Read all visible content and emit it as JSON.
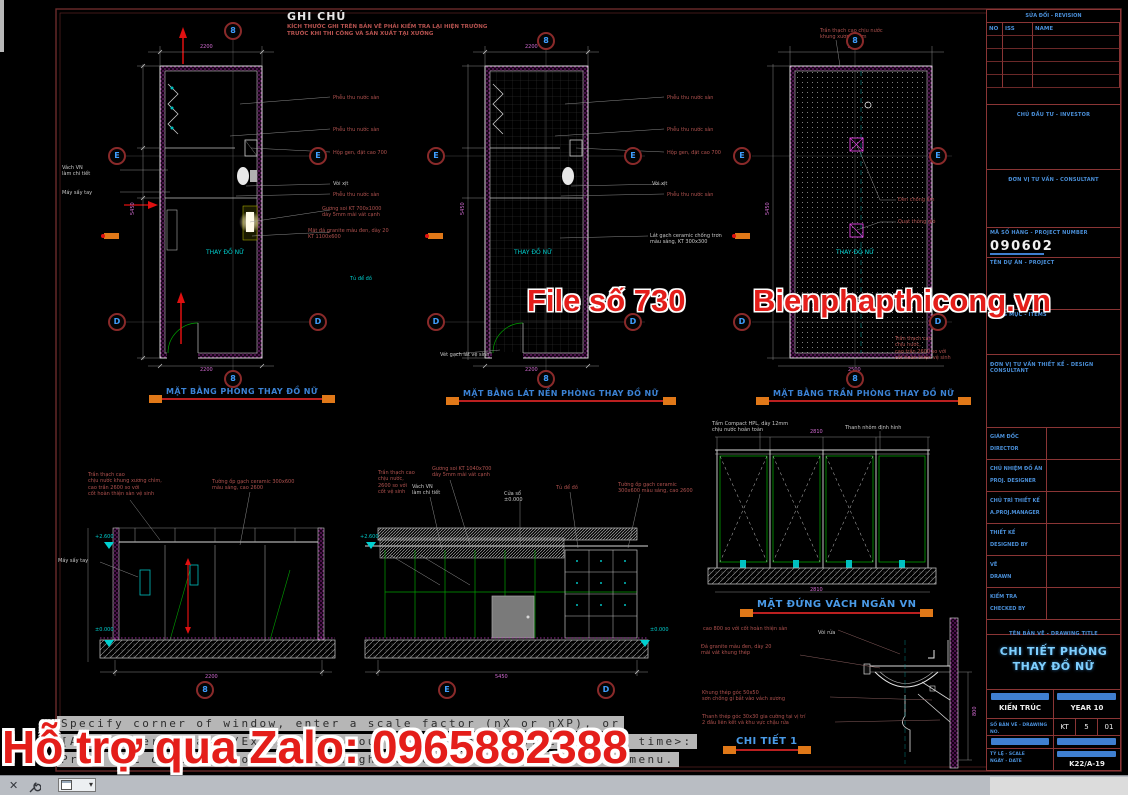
{
  "note": {
    "title": "GHI CHÚ",
    "body": "KÍCH THƯỚC GHI TRÊN BẢN VẼ PHẢI KIỂM TRA LẠI HIỆN TRƯỜNG TRƯỚC KHI THI CÔNG VÀ SẢN XUẤT TẠI XƯỞNG"
  },
  "watermarks": {
    "file_no": "File số 730",
    "site": "Bienphapthicong.vn",
    "zalo": "Hỗ trợ qua Zalo: 0965882388"
  },
  "drawing_titles": {
    "plan1": "MẶT BẰNG PHÒNG THAY ĐỒ NỮ",
    "plan2": "MẶT BẰNG LÁT NỀN PHÒNG THAY ĐỒ NỮ",
    "plan3": "MẶT BẰNG TRẦN PHÒNG THAY ĐỒ NỮ",
    "elevation": "MẶT ĐỨNG VÁCH NGĂN VN",
    "detail": "CHI TIẾT 1"
  },
  "titleblock": {
    "revision_title": "SỬA ĐỔI - REVISION",
    "revision_headers": [
      "NO",
      "ISS",
      "NAME"
    ],
    "investor_label": "CHỦ ĐẦU TƯ - INVESTOR",
    "consultant_label": "ĐƠN VỊ TƯ VẤN - CONSULTANT",
    "project_number_label": "MÃ SỐ HÀNG - PROJECT NUMBER",
    "project_number": "090602",
    "project_label": "TÊN DỰ ÁN - PROJECT",
    "items_label": "HẠNG MỤC - ITEMS",
    "design_unit_label": "ĐƠN VỊ TƯ VẤN THIẾT KẾ - DESIGN CONSULTANT",
    "staff_rows": [
      {
        "vn": "GIÁM ĐỐC",
        "en": "DIRECTOR"
      },
      {
        "vn": "CHỦ NHIỆM ĐỒ ÁN",
        "en": "PROJ. DESIGNER"
      },
      {
        "vn": "CHỦ TRÌ THIẾT KẾ",
        "en": "A.PROJ.MANAGER"
      },
      {
        "vn": "THIẾT KẾ",
        "en": "DESIGNED BY"
      },
      {
        "vn": "VẼ",
        "en": "DRAWN"
      },
      {
        "vn": "KIỂM TRA",
        "en": "CHECKED BY"
      }
    ],
    "drawing_title_label": "TÊN BẢN VẼ - DRAWING TITLE",
    "drawing_title_line1": "CHI TIẾT PHÒNG",
    "drawing_title_line2": "THAY ĐỒ NỮ",
    "discipline": "KIẾN TRÚC",
    "year_label": "YEAR 10",
    "dwg_no_label": "SỐ BẢN VẼ - DRAWING NO.",
    "dwg_series": "KT",
    "sheet_no": "5",
    "sheet_total": "01",
    "scale_label": "TỶ LỆ - SCALE",
    "date_label": "NGÀY - DATE",
    "code": "K22/A-19"
  },
  "command_line": {
    "line1": "Specify corner of window, enter a scale factor (nX or nXP), or",
    "line2": "[All/Center/Dynamic/Extents/Previous/Scale/Window/Object] <real time>:",
    "line3": "Press ESC or ENTER to exit, or right-click to display shortcut menu."
  },
  "bubbles": [
    {
      "l": "8",
      "x": 233,
      "y": 31
    },
    {
      "l": "E",
      "x": 117,
      "y": 156
    },
    {
      "l": "E",
      "x": 318,
      "y": 156
    },
    {
      "l": "D",
      "x": 117,
      "y": 322
    },
    {
      "l": "D",
      "x": 318,
      "y": 322
    },
    {
      "l": "8",
      "x": 233,
      "y": 379
    },
    {
      "l": "8",
      "x": 546,
      "y": 41
    },
    {
      "l": "E",
      "x": 436,
      "y": 156
    },
    {
      "l": "E",
      "x": 633,
      "y": 156
    },
    {
      "l": "D",
      "x": 436,
      "y": 322
    },
    {
      "l": "D",
      "x": 633,
      "y": 322
    },
    {
      "l": "8",
      "x": 546,
      "y": 379
    },
    {
      "l": "8",
      "x": 855,
      "y": 41
    },
    {
      "l": "E",
      "x": 742,
      "y": 156
    },
    {
      "l": "E",
      "x": 938,
      "y": 156
    },
    {
      "l": "D",
      "x": 742,
      "y": 322
    },
    {
      "l": "D",
      "x": 938,
      "y": 322
    },
    {
      "l": "8",
      "x": 855,
      "y": 379
    },
    {
      "l": "8",
      "x": 205,
      "y": 690
    },
    {
      "l": "E",
      "x": 447,
      "y": 690
    },
    {
      "l": "D",
      "x": 606,
      "y": 690
    }
  ],
  "labels": [
    {
      "t": "Phễu thu nước sàn",
      "x": 333,
      "y": 95
    },
    {
      "t": "Phễu thu nước sàn",
      "x": 333,
      "y": 127
    },
    {
      "t": "Hộp gen, đặt cao 700",
      "x": 333,
      "y": 150
    },
    {
      "t": "Vòi xịt",
      "x": 333,
      "y": 181,
      "c": "#c8c8c8"
    },
    {
      "t": "Phễu thu nước sàn",
      "x": 333,
      "y": 192
    },
    {
      "t": "Gương soi KT 700x1000\ndày 5mm mài vát cạnh",
      "x": 322,
      "y": 206
    },
    {
      "t": "Mặt đá granite màu đen, dày 20\nKT 1100x600",
      "x": 308,
      "y": 228
    },
    {
      "t": "Vách VN\nlàm chi tiết",
      "x": 62,
      "y": 165,
      "c": "#c8c8c8"
    },
    {
      "t": "Máy sấy tay",
      "x": 62,
      "y": 190,
      "c": "#c8c8c8"
    },
    {
      "t": "THAY ĐỒ NỮ",
      "x": 206,
      "y": 249,
      "c": "#00cccc",
      "s": 6
    },
    {
      "t": "Tủ để đồ",
      "x": 350,
      "y": 276,
      "c": "#00cccc"
    },
    {
      "t": "Phễu thu nước sàn",
      "x": 667,
      "y": 95
    },
    {
      "t": "Phễu thu nước sàn",
      "x": 667,
      "y": 127
    },
    {
      "t": "Hộp gen, đặt cao 700",
      "x": 667,
      "y": 150
    },
    {
      "t": "Vòi xịt",
      "x": 652,
      "y": 181,
      "c": "#c8c8c8"
    },
    {
      "t": "Phễu thu nước sàn",
      "x": 667,
      "y": 192
    },
    {
      "t": "Lát gạch ceramic chống trơn\nmàu sáng, KT 300x300",
      "x": 650,
      "y": 233,
      "c": "#c8c8c8"
    },
    {
      "t": "THAY ĐỒ NỮ",
      "x": 514,
      "y": 249,
      "c": "#00cccc",
      "s": 6
    },
    {
      "t": "Vét gạch lát vệ sinh",
      "x": 440,
      "y": 352,
      "c": "#c8c8c8"
    },
    {
      "t": "Trần thạch cao chịu nước\nkhung xương chìm",
      "x": 820,
      "y": 28
    },
    {
      "t": "Đèn chống ẩm",
      "x": 898,
      "y": 197
    },
    {
      "t": "Quạt thông gió",
      "x": 898,
      "y": 219
    },
    {
      "t": "THAY ĐỒ NỮ",
      "x": 836,
      "y": 249,
      "c": "#00cccc",
      "s": 6
    },
    {
      "t": "Trần thạch cao\nchịu nước,\ncao trần 2600 so với\ncốt hoàn thiện vệ sinh",
      "x": 895,
      "y": 336
    },
    {
      "t": "Trần thạch cao\nchịu nước khung xương chìm,\ncao trần 2600 so với\ncốt hoàn thiện sàn vệ sinh",
      "x": 88,
      "y": 472
    },
    {
      "t": "Tường ốp gạch ceramic 300x600\nmàu sáng, cao 2600",
      "x": 212,
      "y": 479
    },
    {
      "t": "Máy sấy tay",
      "x": 58,
      "y": 558,
      "c": "#c8c8c8"
    },
    {
      "t": "Trần thạch cao\nchịu nước,\n2600 so với\ncốt vệ sinh",
      "x": 378,
      "y": 470
    },
    {
      "t": "Gương soi KT 1040x700\ndày 5mm mài vát cạnh",
      "x": 432,
      "y": 466
    },
    {
      "t": "Vách VN\nlàm chi tiết",
      "x": 412,
      "y": 484,
      "c": "#c8c8c8"
    },
    {
      "t": "Cửa sổ\n±0.000",
      "x": 504,
      "y": 491,
      "c": "#c8c8c8"
    },
    {
      "t": "Tủ để đồ",
      "x": 556,
      "y": 485
    },
    {
      "t": "Tường ốp gạch ceramic\n300x600 màu sáng, cao 2600",
      "x": 618,
      "y": 482
    },
    {
      "t": "Tấm Compact HPL, dày 12mm\nchịu nước hoàn toàn",
      "x": 712,
      "y": 421,
      "c": "#c8c8c8"
    },
    {
      "t": "Thanh nhôm định hình",
      "x": 845,
      "y": 425,
      "c": "#c8c8c8"
    },
    {
      "t": "cao 800 so với cốt hoàn thiện sàn",
      "x": 703,
      "y": 626
    },
    {
      "t": "Vòi rửa",
      "x": 818,
      "y": 630,
      "c": "#c8c8c8"
    },
    {
      "t": "Đá granite màu đen, dày 20\nmài vát khung thép",
      "x": 701,
      "y": 644
    },
    {
      "t": "Khung thép góc 50x50\nsơn chống gỉ bắt vào vách xương",
      "x": 702,
      "y": 690
    },
    {
      "t": "Thanh thép góc 30x30 gia cường tại vị trí\n2 đầu liên kết và khu vực chậu rửa",
      "x": 702,
      "y": 714
    },
    {
      "t": "+2.600",
      "x": 95,
      "y": 534,
      "c": "#00cccc"
    },
    {
      "t": "±0.000",
      "x": 95,
      "y": 627,
      "c": "#00cccc"
    },
    {
      "t": "+2.600",
      "x": 360,
      "y": 534,
      "c": "#00cccc"
    },
    {
      "t": "±0.000",
      "x": 650,
      "y": 627,
      "c": "#00cccc"
    },
    {
      "t": "2200",
      "x": 200,
      "y": 44,
      "c": "#d06ad0",
      "n": "dimension-text"
    },
    {
      "t": "5450",
      "x": 130,
      "y": 215,
      "c": "#d06ad0",
      "r": -90,
      "n": "dimension-text"
    },
    {
      "t": "2200",
      "x": 200,
      "y": 367,
      "c": "#d06ad0",
      "n": "dimension-text"
    },
    {
      "t": "2200",
      "x": 525,
      "y": 44,
      "c": "#d06ad0",
      "n": "dimension-text"
    },
    {
      "t": "5450",
      "x": 460,
      "y": 215,
      "c": "#d06ad0",
      "r": -90,
      "n": "dimension-text"
    },
    {
      "t": "2200",
      "x": 525,
      "y": 367,
      "c": "#d06ad0",
      "n": "dimension-text"
    },
    {
      "t": "2500",
      "x": 848,
      "y": 44,
      "c": "#d06ad0",
      "n": "dimension-text"
    },
    {
      "t": "5450",
      "x": 765,
      "y": 215,
      "c": "#d06ad0",
      "r": -90,
      "n": "dimension-text"
    },
    {
      "t": "2500",
      "x": 848,
      "y": 367,
      "c": "#d06ad0",
      "n": "dimension-text"
    },
    {
      "t": "2200",
      "x": 205,
      "y": 674,
      "c": "#d06ad0",
      "n": "dimension-text"
    },
    {
      "t": "5450",
      "x": 495,
      "y": 674,
      "c": "#d06ad0",
      "n": "dimension-text"
    },
    {
      "t": "2810",
      "x": 810,
      "y": 429,
      "c": "#d06ad0",
      "n": "dimension-text"
    },
    {
      "t": "2810",
      "x": 810,
      "y": 587,
      "c": "#d06ad0",
      "n": "dimension-text"
    },
    {
      "t": "800",
      "x": 972,
      "y": 716,
      "c": "#d06ad0",
      "r": -90,
      "n": "dimension-text"
    }
  ]
}
